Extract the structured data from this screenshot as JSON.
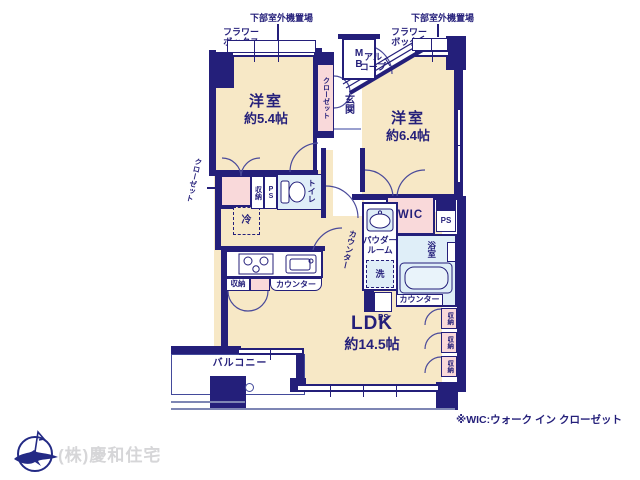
{
  "colors": {
    "wall": "#241f7a",
    "room_fill": "#f7e8c6",
    "closet_fill": "#f9d9da",
    "wet_fill": "#dfeef8",
    "rail_gray": "#7e86b4",
    "company_text": "#d6d6d8",
    "logo_navy": "#232a85"
  },
  "annotations": {
    "outdoor_unit": "下部室外機置場",
    "flower_box": "フラワー\nボックス",
    "alcove": "アル\nコープ",
    "meter_box": "M\nB",
    "note": "※WIC:ウォーク イン クローゼット"
  },
  "rooms": {
    "bedroom1_name": "洋室",
    "bedroom1_size": "約5.4帖",
    "bedroom2_name": "洋室",
    "bedroom2_size": "約6.4帖",
    "ldk_name": "LDK",
    "ldk_size": "約14.5帖",
    "entrance": "玄関",
    "toilet": "トイレ",
    "bath": "浴室",
    "powder_room": "パウダー\nルーム",
    "laundry": "洗",
    "wic": "WIC",
    "balcony": "バルコニー",
    "refrigerator": "冷"
  },
  "fixtures": {
    "closet": "クローゼット",
    "storage": "収納",
    "counter": "カウンター",
    "pipe_space": "PS"
  },
  "footer": {
    "company": "(株)慶和住宅"
  }
}
